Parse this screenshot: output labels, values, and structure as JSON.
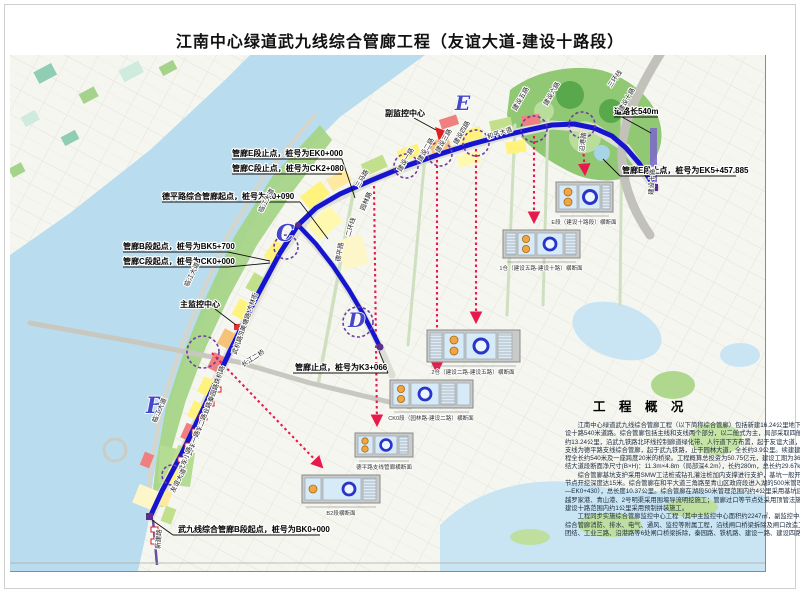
{
  "title": "江南中心绿道武九线综合管廊工程（友谊大道-建设十路段）",
  "colors": {
    "route": "#1515cf",
    "river": "#b9ddef",
    "arrow_red": "#e8194b",
    "node_purple": "#6a3fa0",
    "park_green": "#90c873",
    "highlight_road": "#7d6bc8"
  },
  "map": {
    "section_letters": {
      "b": "B",
      "c": "C",
      "d": "D",
      "e": "E"
    },
    "callouts": {
      "e_end_0": "管廊E段止点，桩号为EK0+000",
      "c_end": "管廊C段止点，桩号为CK2+080",
      "deping_start": "德平路综合管廊起点，桩号为K0+090",
      "b_start_bk5": "管廊B段起点，桩号为BK5+700",
      "c_start": "管廊C段起点，桩号为CK0+000",
      "main_center": "主监控中心",
      "sub_center": "副监控中心",
      "branch_end": "管廊止点，桩号为K3+066",
      "b_start_bk0": "武九线综合管廊B段起点，桩号为BK0+000",
      "road_length": "道路长540m",
      "e_end_457": "管廊E段止点，桩号为EK5+457.885"
    },
    "road_labels": [
      "临江大道",
      "临江大道",
      "临江大道",
      "三马路",
      "园林路",
      "二环线",
      "德平路",
      "建设一路",
      "建设二路",
      "建设三路",
      "建设四路",
      "建设五路",
      "建设六路",
      "建设十路",
      "和平大道",
      "沿港路",
      "三环线",
      "建设十路",
      "才林街",
      "四美塘路",
      "武机路",
      "长江二桥",
      "铁机路",
      "秦园路",
      "工业路",
      "武车二路",
      "武车一路",
      "武车小路",
      "友谊大道",
      "新建路"
    ],
    "inset_captions": [
      "E段（建设十路段）横断面",
      "1仓（建设五路-建设十路）横断面",
      "2仓（建设二路-建设五路）横断面",
      "CK0段（园林路-建设二路）横断面",
      "德平路支线管廊横断面",
      "B2段横断面"
    ]
  },
  "overview": {
    "title": "工 程 概 况",
    "lines": [
      "　　江南中心绿道武九线综合管廊工程（以下简称综合管廊）包括新建16.24公里地下综合管廊及续建建",
      "设十路540米道路。综合管廊包括主线和支线两个部分，以二舱式为主，局部采取四舱形式。主线全长",
      "约13.24公里，沿武九铁路北环线控制廊道绿化带、人行道下方布置，起于友谊大道，止于建设十路；",
      "支线为德平路支线综合管廊，起于武九铁路，止于园林大道，全长约3.9公里。续建建设十路道路排水工",
      "程全长约540米及一座跨度20米的桥梁。工程概算总投资为50.75亿元，建设工期为36个月。　变电站-团",
      "结大道段断面净尺寸(B×H)：11.3m×4.8m（局部深4.2m），长约280m，总长约29.67km。",
      "　　综合管廊基坑支护采用SMW工法桩或钻孔灌注桩加内支撑进行支护，基坑一般开挖深度为8米，局部下穿",
      "节点开挖深度达15米。综合管廊在和平大道三角路至青山区政府段进入湖的500米管理范围内（桩号BK0+720",
      "—EK0+430），总长度10.37公里。综合管廊在湖段50米管理范围内约4公里采用基坑底满堂加固；综合管廊在穿",
      "越罗家港、青山港、2号明渠采用围堰导流明挖施工；管廊过口等节点处采用顶管法施工；在和平大道至",
      "建设十路范围内约1公里采用预制拼装施工。",
      "　　工程同步实施综合管廊监控中心工程（其中主监控中心面积约2247㎡，副监控中心面积约1598㎡），",
      "综合管廊消防、排水、电气、通风、监控等附属工程，沿线闸口桥梁拆除及闸口改造工程（其中和平大道",
      "团结、工业三路、沿港路等6处闸口桥梁拆除，秦园路、铁机路、建设一路、建设四路等4处闸口改造）。"
    ]
  }
}
